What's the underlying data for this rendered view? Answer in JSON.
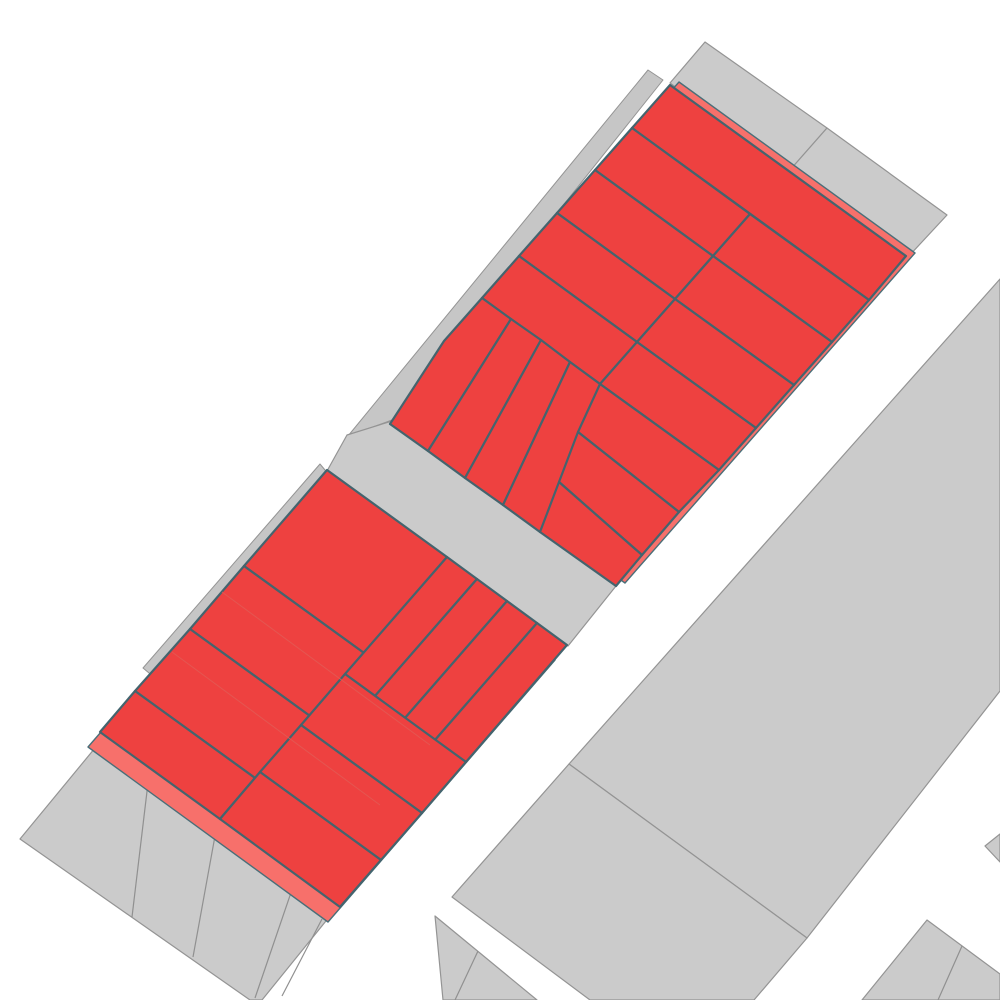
{
  "map": {
    "canvas": {
      "width": 1000,
      "height": 1000,
      "background": "#ffffff"
    },
    "colors": {
      "selected_parcel_fill": "#ee4140",
      "selection_backdrop_fill": "#f7706b",
      "selected_parcel_outline": "#44646e",
      "parcel_fill": "#cbcbcb",
      "parcel_outline": "#949494",
      "street": "#ffffff"
    },
    "shapes": [
      {
        "name": "gray-parcel-top-1",
        "kind": "gray-parcel",
        "interactable": true,
        "points": "705,42 827,128 790,170 670,83"
      },
      {
        "name": "gray-parcel-top-2",
        "kind": "gray-parcel",
        "interactable": true,
        "points": "827,128 947,215 908,257 790,170"
      },
      {
        "name": "gray-parcel-right-upper",
        "kind": "gray-parcel",
        "interactable": true,
        "points": "1000,279 1000,691 807,938 569,764"
      },
      {
        "name": "gray-parcel-right-lower",
        "kind": "gray-parcel",
        "interactable": true,
        "points": "569,764 807,938 754,1000 590,1000 452,897"
      },
      {
        "name": "gray-sliver-upper-block",
        "kind": "gray-sliver",
        "interactable": false,
        "points": "648,70 663,80 392,420 348,436"
      },
      {
        "name": "gray-road-between-blocks",
        "kind": "gray-road",
        "interactable": false,
        "points": "392,421 616,586 568,646 327,471 347,435"
      },
      {
        "name": "gray-sliver-lower-block",
        "kind": "gray-sliver",
        "interactable": false,
        "points": "320,464 330,476 155,678 143,668"
      },
      {
        "name": "gray-band-bottom-left",
        "kind": "gray-parcel",
        "interactable": true,
        "points": "95,748 330,916 262,1000 250,1000 20,839"
      },
      {
        "name": "gray-band-divider-1",
        "kind": "gray-divider",
        "interactable": false,
        "points": "148,783 132,917"
      },
      {
        "name": "gray-band-divider-2",
        "kind": "gray-divider",
        "interactable": false,
        "points": "217,825 193,957"
      },
      {
        "name": "gray-band-divider-3",
        "kind": "gray-divider",
        "interactable": false,
        "points": "297,875 255,998"
      },
      {
        "name": "gray-band-divider-4",
        "kind": "gray-divider",
        "interactable": false,
        "points": "322,919 282,996"
      },
      {
        "name": "gray-wedge-bottom-center",
        "kind": "gray-parcel",
        "interactable": true,
        "points": "435,916 537,1000 443,1000"
      },
      {
        "name": "gray-wedge-divider",
        "kind": "gray-divider",
        "interactable": false,
        "points": "478,951 455,1000"
      },
      {
        "name": "gray-parcel-bottom-right",
        "kind": "gray-parcel",
        "interactable": true,
        "points": "862,1000 927,920 1000,974 1000,1000"
      },
      {
        "name": "gray-bottom-right-divider",
        "kind": "gray-divider",
        "interactable": false,
        "points": "962,946 938,1000"
      },
      {
        "name": "gray-triangle-right-edge",
        "kind": "gray-parcel",
        "interactable": true,
        "points": "985,846 1000,834 1000,862"
      },
      {
        "name": "selection-backdrop-upper",
        "kind": "pink-backdrop",
        "interactable": false,
        "points": "679,82 915,253 625,583 399,421 491,295"
      },
      {
        "name": "selection-backdrop-lower",
        "kind": "pink-backdrop",
        "interactable": false,
        "points": "315,485 555,660 328,922 88,747"
      },
      {
        "name": "red-parcel-u1",
        "kind": "red-parcel",
        "interactable": true,
        "points": "670,85 906,256 869,300 632,128"
      },
      {
        "name": "red-parcel-u2",
        "kind": "red-parcel",
        "interactable": true,
        "points": "632,128 750,214 713,256 595,170"
      },
      {
        "name": "red-parcel-u3",
        "kind": "red-parcel",
        "interactable": true,
        "points": "750,214 869,300 832,342 713,256"
      },
      {
        "name": "red-parcel-u4",
        "kind": "red-parcel",
        "interactable": true,
        "points": "595,170 713,256 675,299 557,213"
      },
      {
        "name": "red-parcel-u5",
        "kind": "red-parcel",
        "interactable": true,
        "points": "713,256 832,342 794,385 675,299"
      },
      {
        "name": "red-parcel-u6",
        "kind": "red-parcel",
        "interactable": true,
        "points": "557,213 675,299 637,342 519,256"
      },
      {
        "name": "red-parcel-u7",
        "kind": "red-parcel",
        "interactable": true,
        "points": "675,299 794,385 756,428 637,342"
      },
      {
        "name": "red-parcel-u8",
        "kind": "red-parcel",
        "interactable": true,
        "points": "519,256 637,342 600,384 482,298"
      },
      {
        "name": "red-parcel-u9",
        "kind": "red-parcel",
        "interactable": true,
        "points": "637,342 756,428 719,470 600,384"
      },
      {
        "name": "red-parcel-u-strip-1",
        "kind": "red-parcel",
        "interactable": true,
        "points": "482,298 511,319 428,451 390,424 444,341"
      },
      {
        "name": "red-parcel-u-strip-2",
        "kind": "red-parcel",
        "interactable": true,
        "points": "511,319 541,340 465,478 428,451"
      },
      {
        "name": "red-parcel-u-strip-3",
        "kind": "red-parcel",
        "interactable": true,
        "points": "541,340 570,362 503,505 465,478"
      },
      {
        "name": "red-parcel-u-strip-4",
        "kind": "red-parcel",
        "interactable": true,
        "points": "570,362 600,384 540,532 503,505"
      },
      {
        "name": "red-parcel-u10",
        "kind": "red-parcel",
        "interactable": true,
        "points": "600,384 719,470 679,512 578,432"
      },
      {
        "name": "red-parcel-u11",
        "kind": "red-parcel",
        "interactable": true,
        "points": "578,432 679,512 642,555 559,482"
      },
      {
        "name": "red-parcel-u12",
        "kind": "red-parcel",
        "interactable": true,
        "points": "559,482 642,555 616,586 540,532"
      },
      {
        "name": "red-parcel-l1",
        "kind": "red-parcel",
        "interactable": true,
        "points": "327,470 447,557 364,653 244,566"
      },
      {
        "name": "red-parcel-l2",
        "kind": "red-parcel",
        "interactable": true,
        "points": "244,566 364,653 310,716 190,629"
      },
      {
        "name": "red-parcel-l3",
        "kind": "red-parcel",
        "interactable": true,
        "points": "190,629 310,716 255,778 135,691"
      },
      {
        "name": "red-parcel-l4",
        "kind": "red-parcel",
        "interactable": true,
        "points": "135,691 255,778 220,819 100,732"
      },
      {
        "name": "red-parcel-l-strip-1",
        "kind": "red-parcel",
        "interactable": true,
        "points": "447,557 477,579 375,696 345,674"
      },
      {
        "name": "red-parcel-l-strip-2",
        "kind": "red-parcel",
        "interactable": true,
        "points": "477,579 507,601 405,718 375,696"
      },
      {
        "name": "red-parcel-l-strip-3",
        "kind": "red-parcel",
        "interactable": true,
        "points": "507,601 537,623 435,740 405,718"
      },
      {
        "name": "red-parcel-l-strip-4",
        "kind": "red-parcel",
        "interactable": true,
        "points": "537,623 567,645 466,762 435,740"
      },
      {
        "name": "red-parcel-l5",
        "kind": "red-parcel",
        "interactable": true,
        "points": "345,674 466,762 422,813 301,725"
      },
      {
        "name": "red-parcel-l6",
        "kind": "red-parcel",
        "interactable": true,
        "points": "301,725 422,813 381,860 260,772"
      },
      {
        "name": "red-parcel-l7",
        "kind": "red-parcel",
        "interactable": true,
        "points": "260,772 381,860 340,907 220,819"
      },
      {
        "name": "faint-backdrop-seam-lower",
        "kind": "faint-line",
        "interactable": false,
        "points": "222,592 430,745"
      },
      {
        "name": "faint-backdrop-seam-lower-2",
        "kind": "faint-line",
        "interactable": false,
        "points": "172,652 380,805"
      }
    ]
  }
}
